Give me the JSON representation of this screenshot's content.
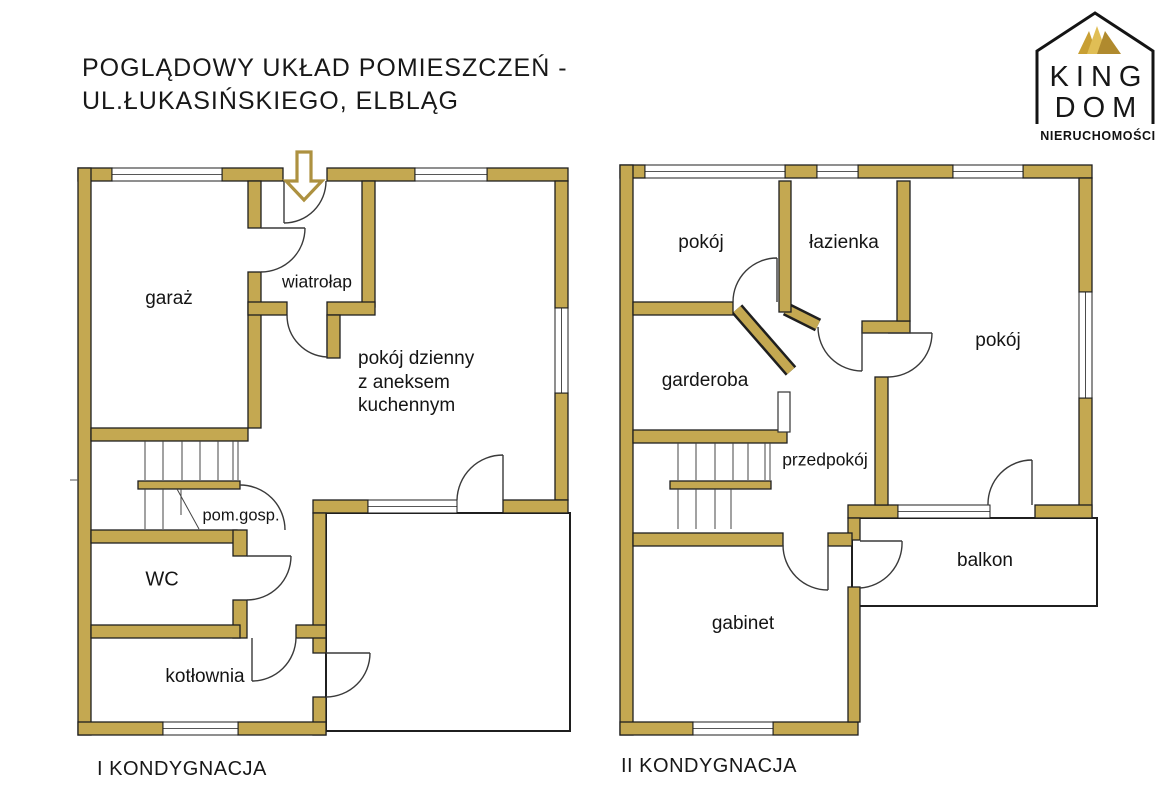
{
  "title": {
    "line1": "POGLĄDOWY UKŁAD POMIESZCZEŃ -",
    "line2": "UL.ŁUKASIŃSKIEGO, ELBLĄG"
  },
  "logo": {
    "name_top": "KING",
    "name_bottom": "DOM",
    "subtitle": "NIERUCHOMOŚCI"
  },
  "floor1": {
    "label": "I KONDYGNACJA",
    "rooms": {
      "garage": "garaż",
      "vestibule": "wiatrołap",
      "living_line1": "pokój dzienny",
      "living_line2": "z aneksem",
      "living_line3": "kuchennym",
      "utility": "pom.gosp.",
      "wc": "WC",
      "boiler": "kotłownia"
    }
  },
  "floor2": {
    "label": "II KONDYGNACJA",
    "rooms": {
      "room_top": "pokój",
      "bathroom": "łazienka",
      "room_right": "pokój",
      "wardrobe": "garderoba",
      "hall": "przedpokój",
      "office": "gabinet",
      "balcony": "balkon"
    }
  },
  "colors": {
    "wall": "#C4A851",
    "line": "#1f1f1f",
    "crown_gold": "#C89F33"
  }
}
